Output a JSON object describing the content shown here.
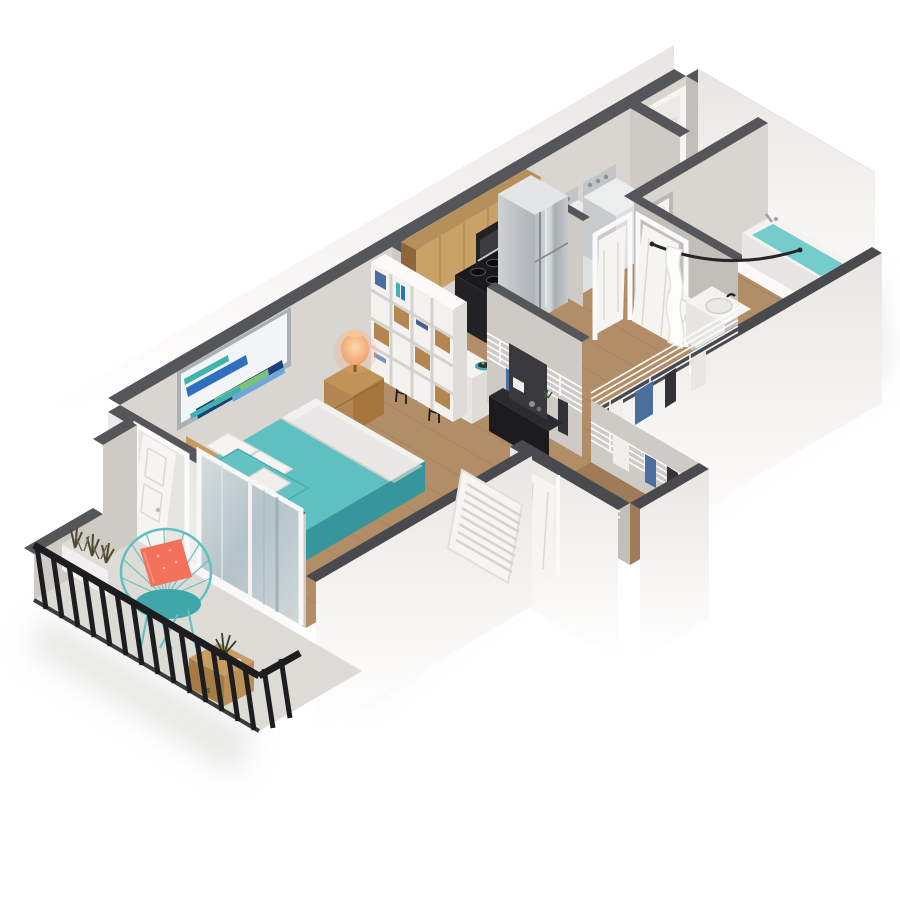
{
  "title": "3d-isometric-apartment-floor-plan",
  "colors": {
    "wall-a": "#d9d6d1",
    "wall-b": "#cecbc6",
    "wall-c": "#c2bfba",
    "cap": "#55565a",
    "cap-front": "#494a4e",
    "white": "#f4f3f0",
    "white-dim": "#e7e6e2",
    "floor": "#b28e68",
    "floor-dark": "#a07b58",
    "concrete": "#dcdbd6",
    "teal": "#5fc0c2",
    "teal-dark": "#3fa6aa",
    "tub-water": "#74cccd",
    "coral": "#f3705b",
    "wood": "#b3874f",
    "wood-dark": "#8e6639",
    "cabinet-wood": "#c9a268",
    "appliance-black": "#222224",
    "steel-light": "#d3d6d8",
    "steel-dark": "#9aa0a4",
    "denim": "#4a6e9e",
    "cloth-dark": "#323237",
    "door-white": "#f6f5f2",
    "railing-black": "#1d1d1f",
    "plank-line": "#967550",
    "art-navy": "#1d3f7e",
    "art-blue": "#2f6fbe",
    "art-teal": "#3fb3ae",
    "art-green": "#7cc474",
    "lamp-glow": "#f6a97c"
  },
  "scene": {
    "rooms": [
      {
        "name": "bedroom-living-area"
      },
      {
        "name": "kitchen"
      },
      {
        "name": "laundry-nook"
      },
      {
        "name": "entry"
      },
      {
        "name": "hallway"
      },
      {
        "name": "bathroom"
      },
      {
        "name": "walk-in-closet"
      },
      {
        "name": "secondary-closet"
      },
      {
        "name": "balcony"
      }
    ],
    "furniture": [
      "double-bed-teal-bedding",
      "wood-headboard",
      "white-and-teal-pillows",
      "abstract-wall-art",
      "nightstand",
      "orange-table-lamp",
      "white-cube-shelf-with-baskets",
      "black-tv-console",
      "television",
      "white-bar-counter-with-sink",
      "two-bar-stools",
      "wood-upper-cabinets",
      "microwave",
      "black-range-oven",
      "stainless-refrigerator",
      "washer",
      "dryer",
      "toilet",
      "bathtub-with-water",
      "vanity-sink",
      "shower-curtain",
      "curved-shower-rod",
      "wire-closet-shelving",
      "hanging-clothes",
      "black-balcony-railing",
      "white-planter-box",
      "teal-wire-lounge-chair",
      "coral-throw-pillow",
      "wood-cube-side-table",
      "potted-plant",
      "entry-door",
      "interior-doors",
      "sliding-glass-door",
      "louvered-door"
    ]
  }
}
